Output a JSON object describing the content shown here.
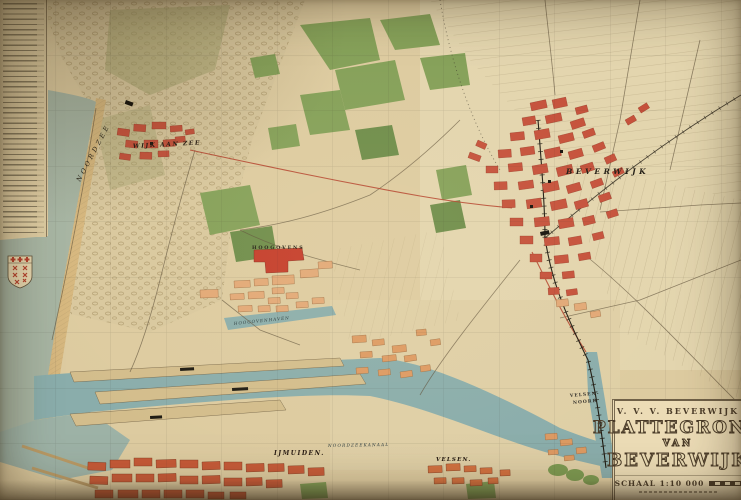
{
  "map": {
    "place_labels": {
      "sea": "NOORDZEE",
      "wijk_aan_zee": "WIJK AAN ZEE",
      "beverwijk": "BEVERWIJK",
      "hoogovens": "HOOGOVENS",
      "hoogovenhaven": "HOOGOVENHAVEN",
      "noordzeekanaal": "NOORDZEEKANAAL",
      "ijmuiden": "IJMUIDEN.",
      "velsen": "VELSEN.",
      "velsen_noord_line1": "VELSEN-",
      "velsen_noord_line2": "NOORD"
    },
    "cartouche": {
      "org": "V. V. V.  BEVERWIJK",
      "title": "PLATTEGROND",
      "connector": "VAN",
      "city": "BEVERWIJK",
      "scale": "SCHAAL 1:10 000"
    },
    "colors": {
      "paper": "#ddcba0",
      "polder_paper": "#e3d5ae",
      "sea": "#a6b4a2",
      "harbor_water": "#8aadab",
      "beach": "#d6b77e",
      "town_red": "#c5503a",
      "block_orange": "#e2a876",
      "woods_green": "#84a058",
      "ink": "#3a3226"
    }
  }
}
